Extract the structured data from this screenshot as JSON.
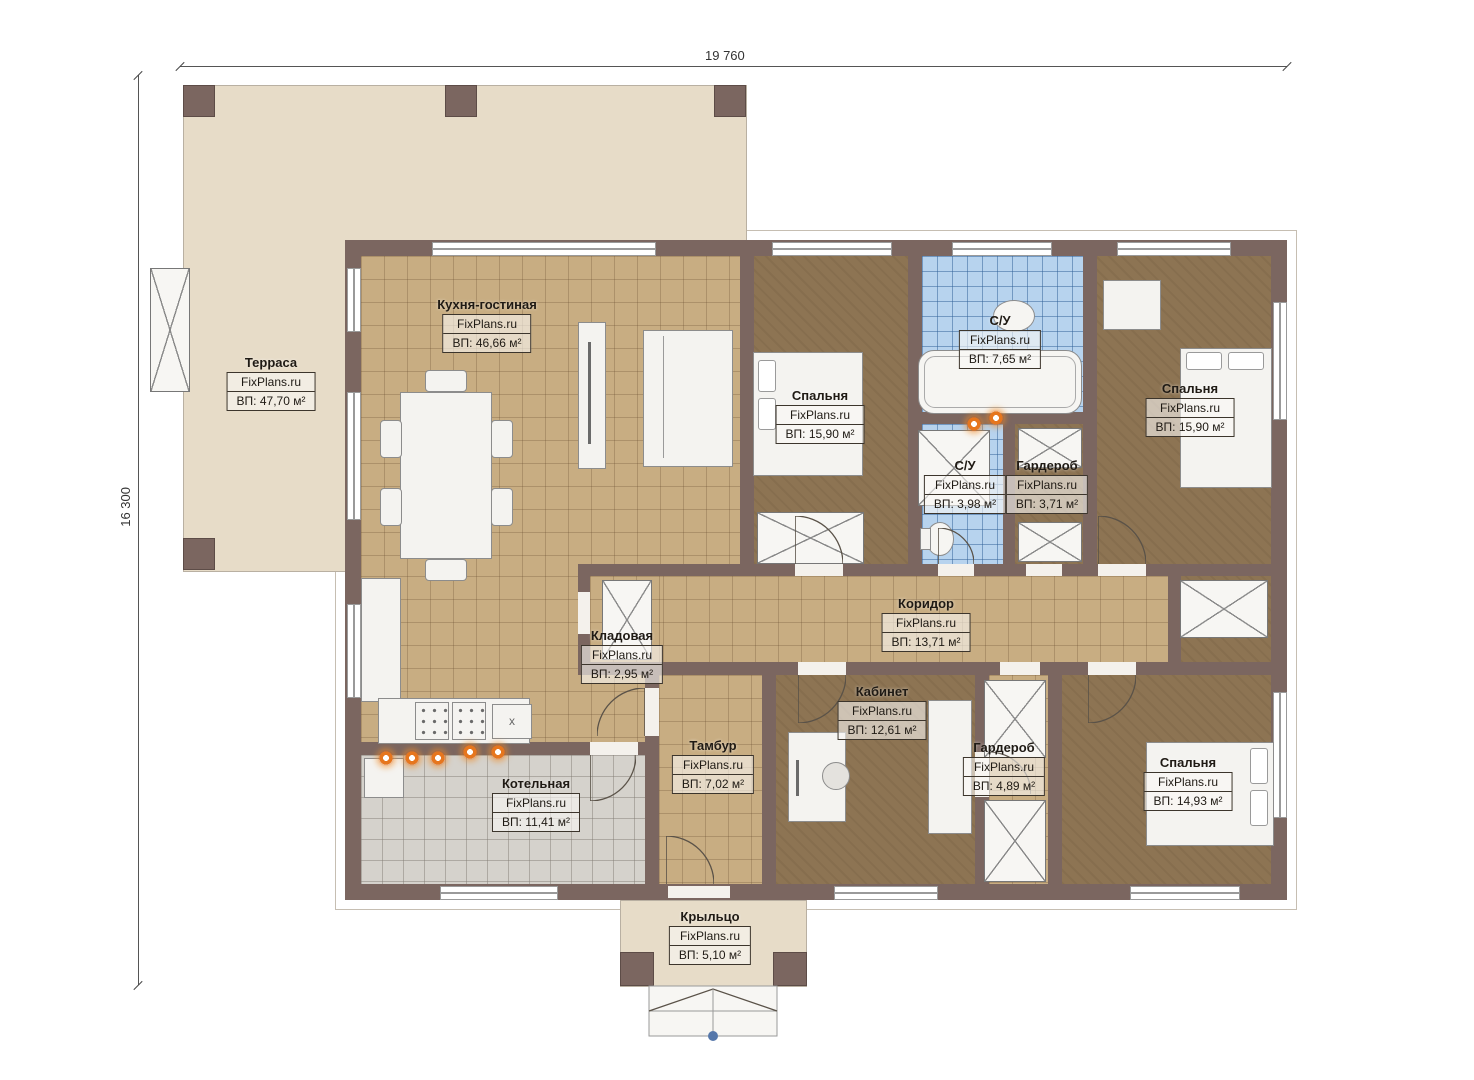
{
  "brand": "FixPlans.ru",
  "dimensions": {
    "width_label": "19 760",
    "height_label": "16 300"
  },
  "palette": {
    "wall": "#7b6660",
    "terrace_floor": "#e7dcc8",
    "tile_floor": "#c8ad82",
    "room_floor": "#8d7453",
    "bath_floor": "#b7d3ee",
    "boiler_floor": "#d5d2cc",
    "heat_marker": "#e6761e",
    "entry_marker": "#5577aa"
  },
  "rooms": {
    "terrace": {
      "name": "Терраса",
      "area": "ВП: 47,70 м²"
    },
    "kitchen": {
      "name": "Кухня-гостиная",
      "area": "ВП: 46,66 м²"
    },
    "bedroom1": {
      "name": "Спальня",
      "area": "ВП: 15,90 м²"
    },
    "bathroom1": {
      "name": "С/У",
      "area": "ВП: 7,65 м²"
    },
    "bedroom2": {
      "name": "Спальня",
      "area": "ВП: 15,90 м²"
    },
    "bathroom2": {
      "name": "С/У",
      "area": "ВП: 3,98 м²"
    },
    "wardrobe1": {
      "name": "Гардероб",
      "area": "ВП: 3,71 м²"
    },
    "corridor": {
      "name": "Коридор",
      "area": "ВП: 13,71 м²"
    },
    "storage": {
      "name": "Кладовая",
      "area": "ВП: 2,95 м²"
    },
    "office": {
      "name": "Кабинет",
      "area": "ВП: 12,61 м²"
    },
    "vestibule": {
      "name": "Тамбур",
      "area": "ВП: 7,02 м²"
    },
    "wardrobe2": {
      "name": "Гардероб",
      "area": "ВП: 4,89 м²"
    },
    "bedroom3": {
      "name": "Спальня",
      "area": "ВП: 14,93 м²"
    },
    "boiler": {
      "name": "Котельная",
      "area": "ВП: 11,41 м²"
    },
    "porch": {
      "name": "Крыльцо",
      "area": "ВП: 5,10 м²"
    }
  }
}
